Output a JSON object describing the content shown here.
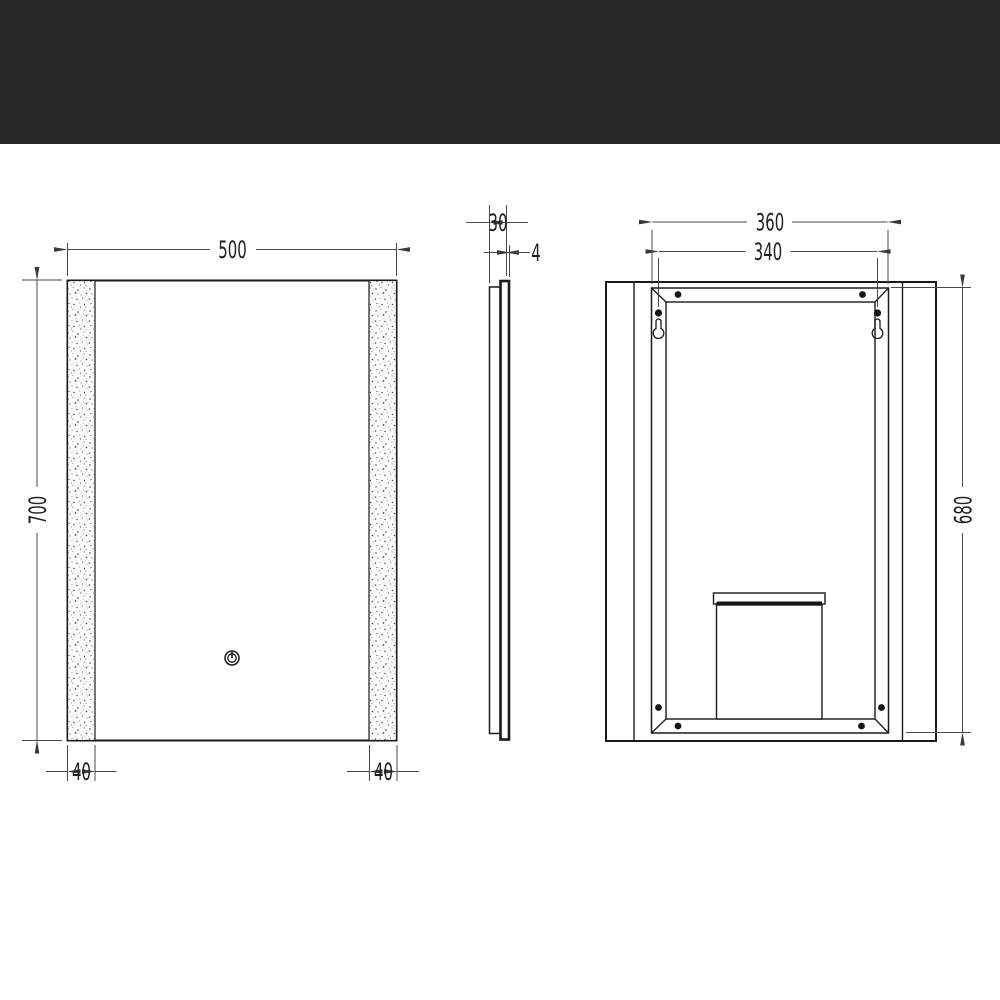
{
  "header": {
    "band_color": "#282828"
  },
  "page": {
    "background": "#ffffff",
    "line_color": "#1a1a1a"
  },
  "drawing": {
    "front_view": {
      "width_mm": "500",
      "height_mm": "700",
      "left_strip_mm": "40",
      "right_strip_mm": "40"
    },
    "side_view": {
      "depth_mm": "30",
      "thickness_mm": "4"
    },
    "back_view": {
      "frame_width_mm": "360",
      "hanger_spacing_mm": "340",
      "frame_height_mm": "680"
    }
  }
}
